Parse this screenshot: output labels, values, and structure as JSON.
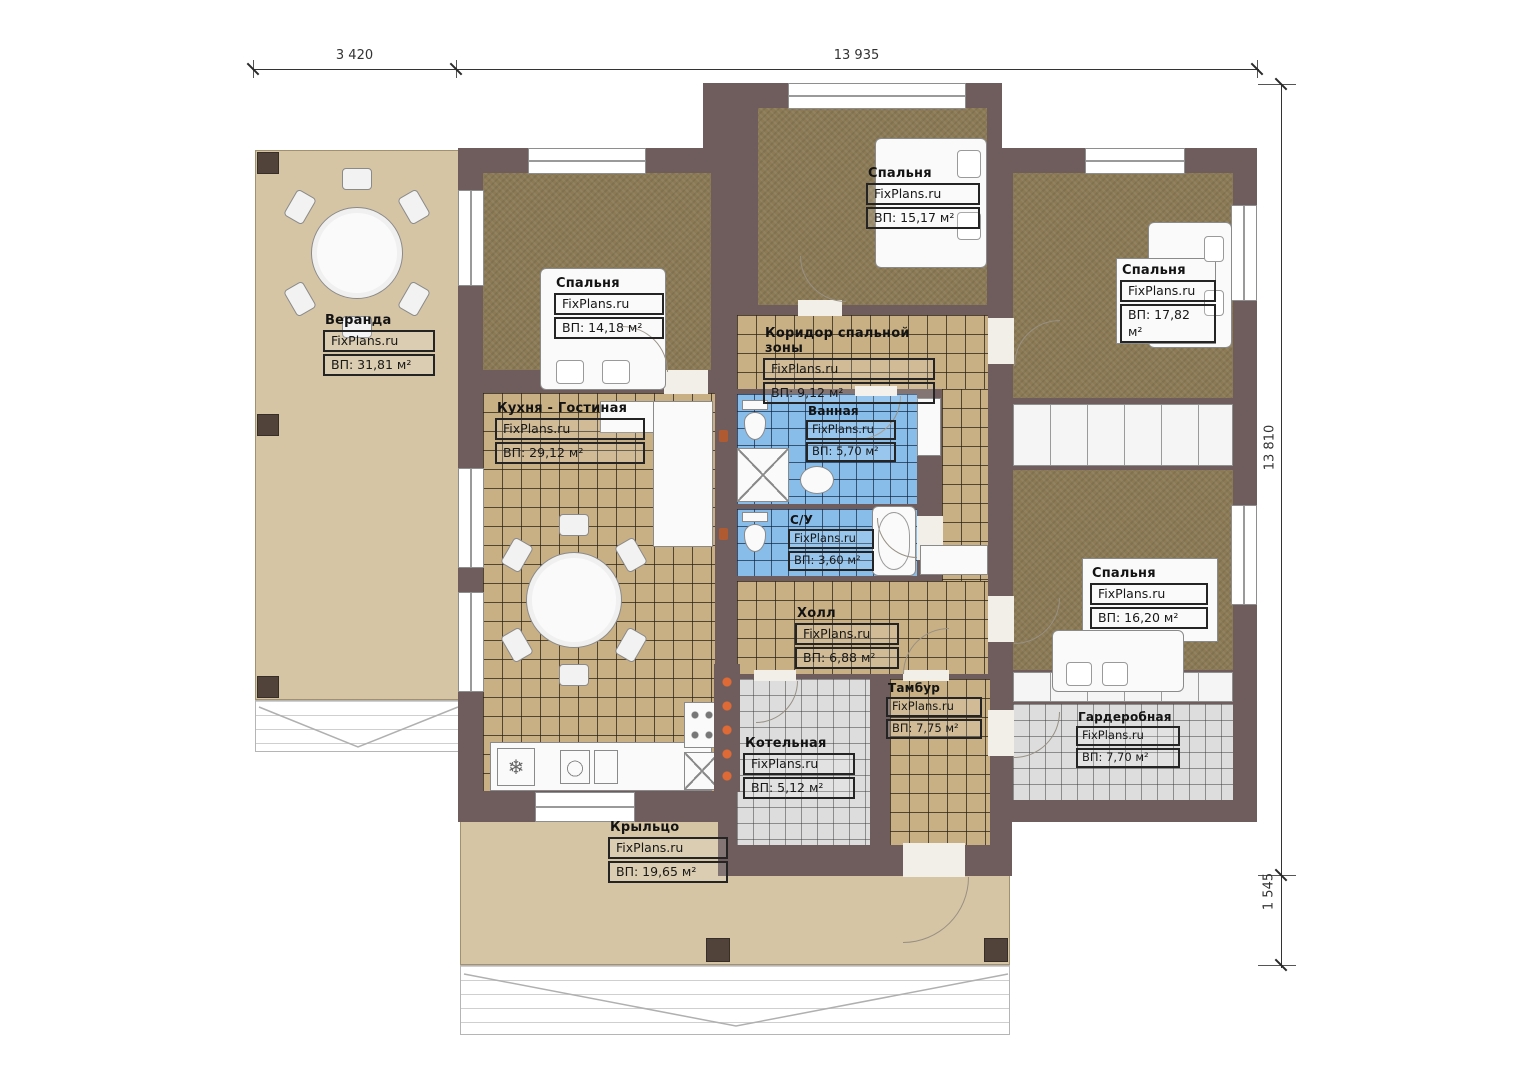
{
  "meta": {
    "brand": "FixPlans.ru"
  },
  "dimensions": {
    "top_left": "3 420",
    "top_right": "13 935",
    "right_main": "13 810",
    "right_bottom": "1 545"
  },
  "rooms": {
    "veranda": {
      "name": "Веранда",
      "area": "ВП: 31,81 м²"
    },
    "bedroom_left": {
      "name": "Спальня",
      "area": "ВП: 14,18 м²"
    },
    "bedroom_top": {
      "name": "Спальня",
      "area": "ВП: 15,17 м²"
    },
    "bedroom_right": {
      "name": "Спальня",
      "area": "ВП: 17,82 м²"
    },
    "corridor": {
      "name": "Коридор спальной зоны",
      "area": "ВП: 9,12 м²"
    },
    "kitchen": {
      "name": "Кухня - Гостиная",
      "area": "ВП: 29,12 м²"
    },
    "bathroom": {
      "name": "Ванная",
      "area": "ВП: 5,70 м²"
    },
    "wc": {
      "name": "С/У",
      "area": "ВП: 3,60 м²"
    },
    "hall": {
      "name": "Холл",
      "area": "ВП: 6,88 м²"
    },
    "bedroom_bottom": {
      "name": "Спальня",
      "area": "ВП: 16,20 м²"
    },
    "tambour": {
      "name": "Тамбур",
      "area": "ВП: 7,75 м²"
    },
    "boiler": {
      "name": "Котельная",
      "area": "ВП: 5,12 м²"
    },
    "wardrobe": {
      "name": "Гардеробная",
      "area": "ВП: 7,70 м²"
    },
    "porch": {
      "name": "Крыльцо",
      "area": "ВП: 19,65 м²"
    }
  },
  "colors": {
    "wall": "#6f5d5d",
    "carpet": "#8b7a55",
    "tile_tan": "#c8b084",
    "tile_blue": "#88bce9",
    "tile_gray": "#dddddd",
    "deck": "#d5c5a4",
    "burner_orange": "#e06a35"
  }
}
